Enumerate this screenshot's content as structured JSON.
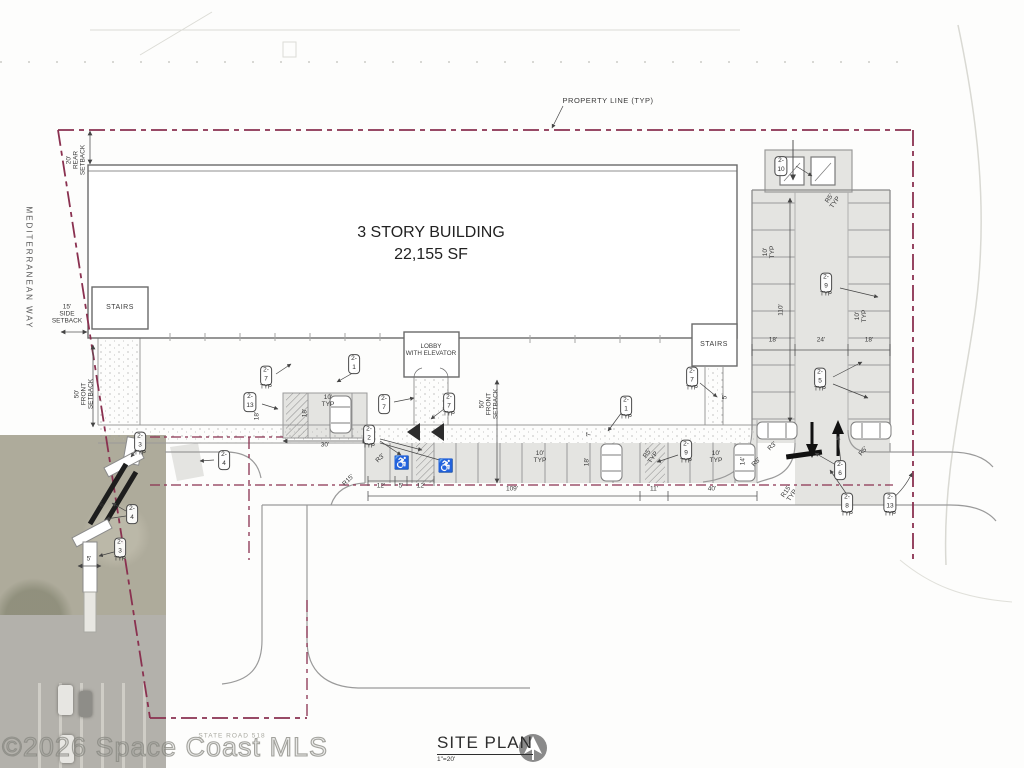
{
  "page": {
    "title": "SITE PLAN",
    "scale": "1\"=20'",
    "watermark": "©2026 Space Coast MLS"
  },
  "building": {
    "name_line1": "3 STORY BUILDING",
    "area": "22,155 SF",
    "rooms": {
      "stairs_left": "STAIRS",
      "stairs_right": "STAIRS",
      "lobby": "LOBBY\nWITH ELEVATOR"
    }
  },
  "streets": {
    "west": "MEDITERRANEAN WAY",
    "south": "STATE ROAD 518"
  },
  "annotations": {
    "property_line": "PROPERTY LINE (TYP)",
    "setback_rear": "20'\nREAR\nSETBACK",
    "setback_side": "15'\nSIDE\nSETBACK",
    "setback_front_west": "50'\nFRONT\nSETBACK",
    "setback_front_center": "50'\nFRONT\nSETBACK"
  },
  "icons": {
    "handicap": "♿",
    "north_arrow": "north-arrow"
  },
  "colors": {
    "property_line": "#8a3150",
    "pavement": "#e4e4e1",
    "linework": "#8f8f8f",
    "building_line": "#6a6a6a",
    "text": "#3a3a3a",
    "photo_base": "#aeab9b"
  },
  "callouts": [
    {
      "label": "2-10",
      "typ": false,
      "x": 781,
      "y": 166
    },
    {
      "label": "2-9",
      "typ": true,
      "x": 826,
      "y": 285
    },
    {
      "label": "2-5",
      "typ": true,
      "x": 820,
      "y": 380
    },
    {
      "label": "2-6",
      "typ": false,
      "x": 840,
      "y": 470
    },
    {
      "label": "2-8",
      "typ": true,
      "x": 847,
      "y": 505
    },
    {
      "label": "2-13",
      "typ": true,
      "x": 890,
      "y": 505
    },
    {
      "label": "2-7",
      "typ": true,
      "x": 266,
      "y": 378
    },
    {
      "label": "2-1",
      "typ": false,
      "x": 354,
      "y": 364
    },
    {
      "label": "2-13",
      "typ": false,
      "x": 250,
      "y": 402
    },
    {
      "label": "2-7",
      "typ": false,
      "x": 384,
      "y": 404
    },
    {
      "label": "2-7",
      "typ": true,
      "x": 449,
      "y": 405
    },
    {
      "label": "2-2",
      "typ": true,
      "x": 369,
      "y": 437
    },
    {
      "label": "2-7",
      "typ": true,
      "x": 692,
      "y": 379
    },
    {
      "label": "2-1",
      "typ": true,
      "x": 626,
      "y": 408
    },
    {
      "label": "2-9",
      "typ": true,
      "x": 686,
      "y": 452
    },
    {
      "label": "2-4",
      "typ": false,
      "x": 224,
      "y": 460
    },
    {
      "label": "2-3",
      "typ": true,
      "x": 140,
      "y": 444
    },
    {
      "label": "2-4",
      "typ": false,
      "x": 132,
      "y": 514
    },
    {
      "label": "2-3",
      "typ": true,
      "x": 120,
      "y": 550
    }
  ],
  "dimensions": [
    {
      "label": "18'",
      "x": 773,
      "y": 341
    },
    {
      "label": "24'",
      "x": 821,
      "y": 341
    },
    {
      "label": "18'",
      "x": 869,
      "y": 341
    },
    {
      "label": "110'",
      "x": 782,
      "y": 310,
      "rot": -90
    },
    {
      "label": "10'\nTYP",
      "x": 770,
      "y": 252,
      "rot": -90
    },
    {
      "label": "10'\nTYP",
      "x": 862,
      "y": 316,
      "rot": -90
    },
    {
      "label": "R5'\nTYP",
      "x": 833,
      "y": 201,
      "rot": -55
    },
    {
      "label": "R5'",
      "x": 864,
      "y": 452,
      "rot": -50
    },
    {
      "label": "R3'",
      "x": 773,
      "y": 447,
      "rot": -45
    },
    {
      "label": "R5'",
      "x": 757,
      "y": 463,
      "rot": -45
    },
    {
      "label": "R15'\nTYP",
      "x": 790,
      "y": 494,
      "rot": -55
    },
    {
      "label": "12'",
      "x": 381,
      "y": 487
    },
    {
      "label": "5'",
      "x": 401,
      "y": 487
    },
    {
      "label": "12'",
      "x": 421,
      "y": 487
    },
    {
      "label": "109'",
      "x": 512,
      "y": 490
    },
    {
      "label": "11'",
      "x": 654,
      "y": 490
    },
    {
      "label": "40'",
      "x": 712,
      "y": 490
    },
    {
      "label": "10'\nTYP",
      "x": 540,
      "y": 458
    },
    {
      "label": "10'\nTYP",
      "x": 716,
      "y": 458
    },
    {
      "label": "7'",
      "x": 590,
      "y": 434,
      "rot": -90
    },
    {
      "label": "18'",
      "x": 588,
      "y": 462,
      "rot": -90
    },
    {
      "label": "14'",
      "x": 744,
      "y": 461,
      "rot": -90
    },
    {
      "label": "5'",
      "x": 726,
      "y": 397,
      "rot": -90
    },
    {
      "label": "R5'\nTYP",
      "x": 651,
      "y": 456,
      "rot": -55
    },
    {
      "label": "R3'",
      "x": 381,
      "y": 459,
      "rot": -45
    },
    {
      "label": "R15'",
      "x": 349,
      "y": 481,
      "rot": -45
    },
    {
      "label": "18'",
      "x": 258,
      "y": 416,
      "rot": -90
    },
    {
      "label": "18'",
      "x": 306,
      "y": 413,
      "rot": -90
    },
    {
      "label": "10'\nTYP",
      "x": 328,
      "y": 402
    },
    {
      "label": "30'",
      "x": 325,
      "y": 446
    },
    {
      "label": "6'",
      "x": 103,
      "y": 505,
      "rot": -55
    },
    {
      "label": "5'",
      "x": 89,
      "y": 560
    }
  ]
}
